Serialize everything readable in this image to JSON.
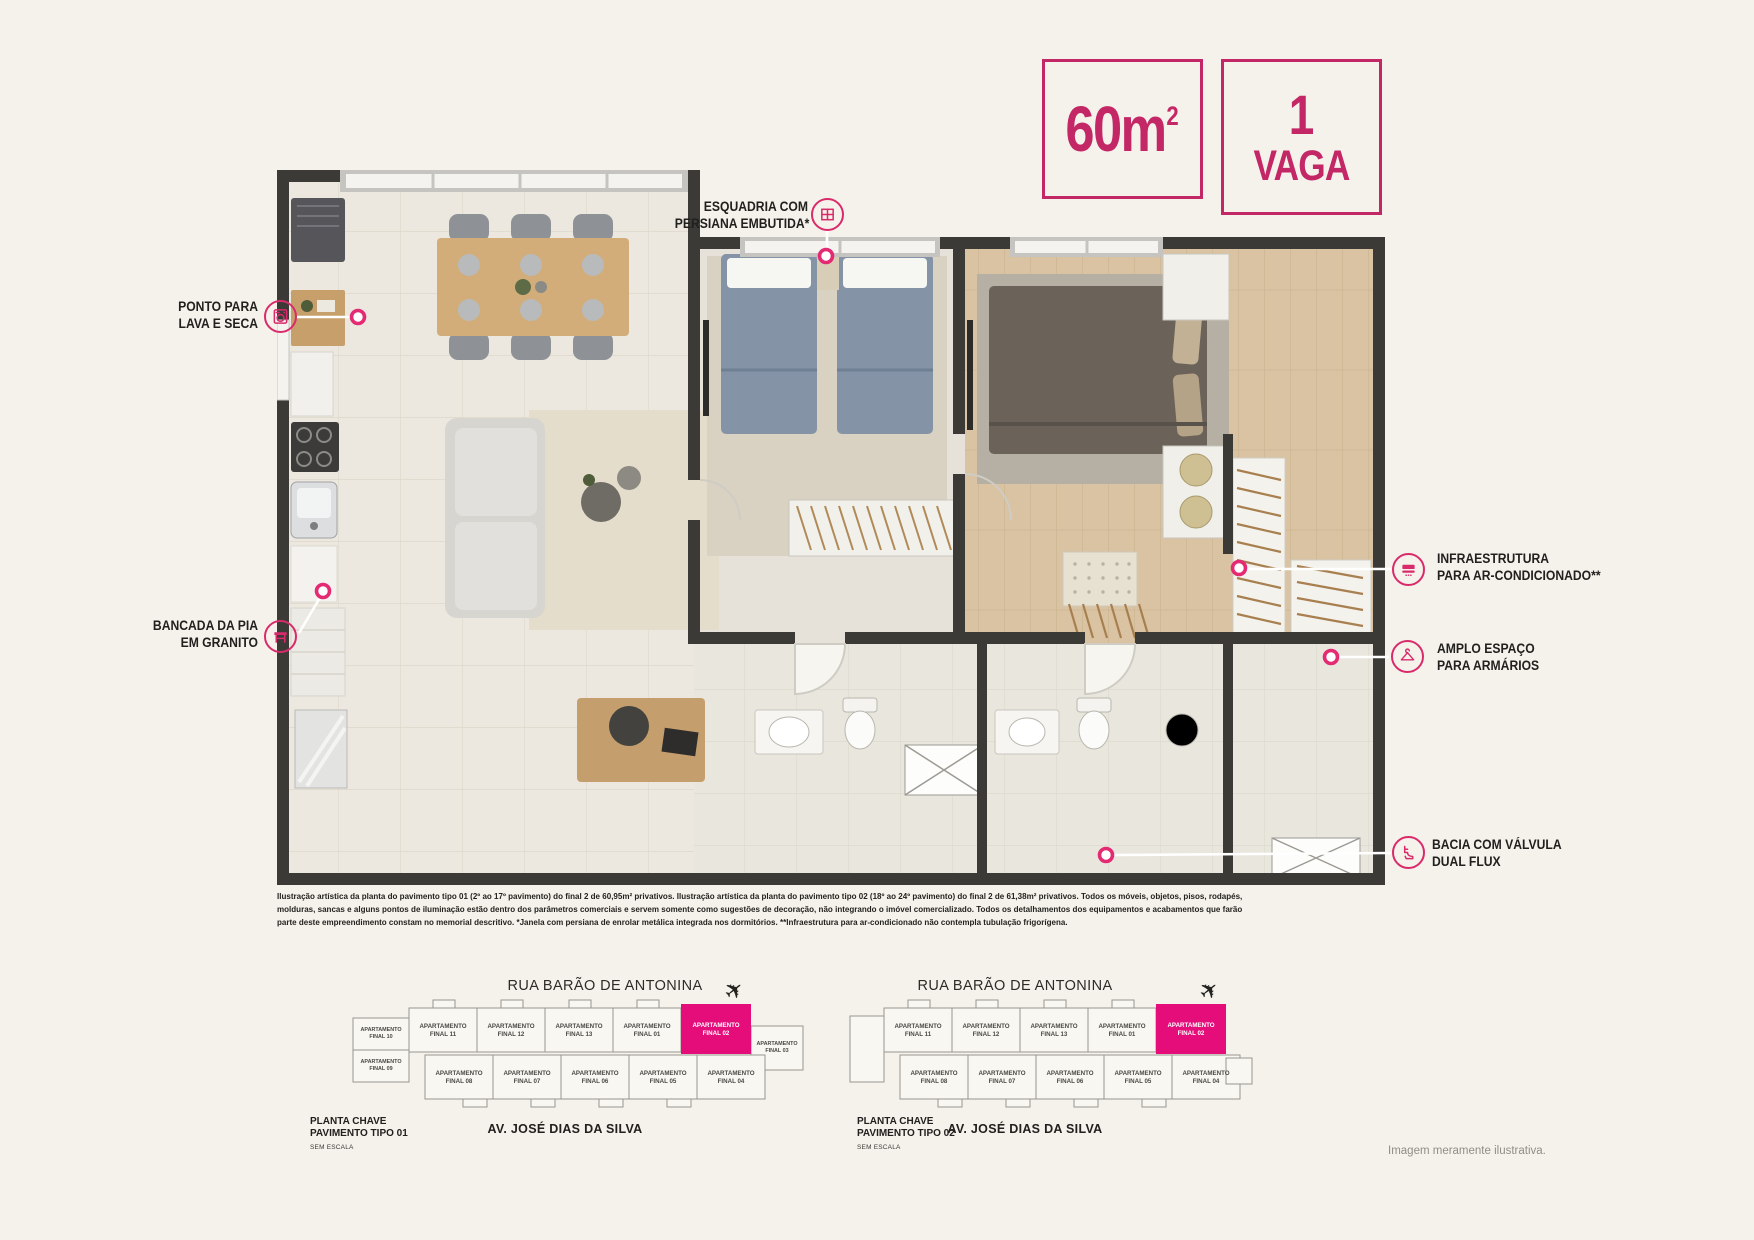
{
  "accent": "#c32766",
  "badges": {
    "area": {
      "number": "60",
      "unit": "m",
      "sup": "2"
    },
    "vaga": {
      "line1": "1",
      "line2": "VAGA"
    }
  },
  "callouts": {
    "lava_seca": {
      "lines": [
        "PONTO PARA",
        "LAVA E SECA"
      ],
      "icon": "washer-icon"
    },
    "bancada": {
      "lines": [
        "BANCADA DA PIA",
        "EM GRANITO"
      ],
      "icon": "counter-icon"
    },
    "esquadria": {
      "lines": [
        "ESQUADRIA COM",
        "PERSIANA EMBUTIDA*"
      ],
      "icon": "window-icon"
    },
    "infra_ac": {
      "lines": [
        "INFRAESTRUTURA",
        "PARA AR-CONDICIONADO**"
      ],
      "icon": "ac-unit-icon"
    },
    "armarios": {
      "lines": [
        "AMPLO ESPAÇO",
        "PARA ARMÁRIOS"
      ],
      "icon": "hanger-icon"
    },
    "bacia": {
      "lines": [
        "BACIA COM VÁLVULA",
        "DUAL FLUX"
      ],
      "icon": "toilet-icon"
    }
  },
  "legal_text": "Ilustração artística da planta do pavimento tipo 01 (2º ao 17º pavimento) do final 2 de 60,95m² privativos. Ilustração artística da planta do pavimento tipo 02 (18º ao 24º pavimento) do final 2 de 61,38m² privativos. Todos os móveis, objetos, pisos, rodapés, molduras, sancas e alguns pontos de iluminação estão dentro dos parâmetros comerciais e servem somente como sugestões de decoração, não integrando o imóvel comercializado. Todos os detalhamentos dos equipamentos e acabamentos que farão parte deste empreendimento constam no memorial descritivo. *Janela com persiana de enrolar metálica integrada nos dormitórios. **Infraestrutura para ar-condicionado não contempla tubulação frigorígena.",
  "key_plans": [
    {
      "street_top": "RUA BARÃO DE ANTONINA",
      "street_bottom": "AV. JOSÉ DIAS DA SILVA",
      "caption": [
        "PLANTA CHAVE",
        "PAVIMENTO TIPO 01"
      ],
      "scale_note": "SEM ESCALA",
      "units_top": [
        [
          "APARTAMENTO",
          "FINAL 11"
        ],
        [
          "APARTAMENTO",
          "FINAL 12"
        ],
        [
          "APARTAMENTO",
          "FINAL 13"
        ],
        [
          "APARTAMENTO",
          "FINAL 01"
        ]
      ],
      "unit_highlight": [
        "APARTAMENTO",
        "FINAL 02"
      ],
      "units_left": [
        [
          "APARTAMENTO",
          "FINAL 10"
        ],
        [
          "APARTAMENTO",
          "FINAL 09"
        ]
      ],
      "unit_right": [
        "APARTAMENTO",
        "FINAL 03"
      ],
      "units_bottom": [
        [
          "APARTAMENTO",
          "FINAL 08"
        ],
        [
          "APARTAMENTO",
          "FINAL 07"
        ],
        [
          "APARTAMENTO",
          "FINAL 06"
        ],
        [
          "APARTAMENTO",
          "FINAL 05"
        ],
        [
          "APARTAMENTO",
          "FINAL 04"
        ]
      ]
    },
    {
      "street_top": "RUA BARÃO DE ANTONINA",
      "street_bottom": "AV. JOSÉ DIAS DA SILVA",
      "caption": [
        "PLANTA CHAVE",
        "PAVIMENTO TIPO 02"
      ],
      "scale_note": "SEM ESCALA",
      "units_top": [
        [
          "APARTAMENTO",
          "FINAL 11"
        ],
        [
          "APARTAMENTO",
          "FINAL 12"
        ],
        [
          "APARTAMENTO",
          "FINAL 13"
        ],
        [
          "APARTAMENTO",
          "FINAL 01"
        ]
      ],
      "unit_highlight": [
        "APARTAMENTO",
        "FINAL 02"
      ],
      "units_bottom": [
        [
          "APARTAMENTO",
          "FINAL 08"
        ],
        [
          "APARTAMENTO",
          "FINAL 07"
        ],
        [
          "APARTAMENTO",
          "FINAL 06"
        ],
        [
          "APARTAMENTO",
          "FINAL 05"
        ],
        [
          "APARTAMENTO",
          "FINAL 04"
        ]
      ]
    }
  ],
  "footnote": "Imagem meramente ilustrativa."
}
